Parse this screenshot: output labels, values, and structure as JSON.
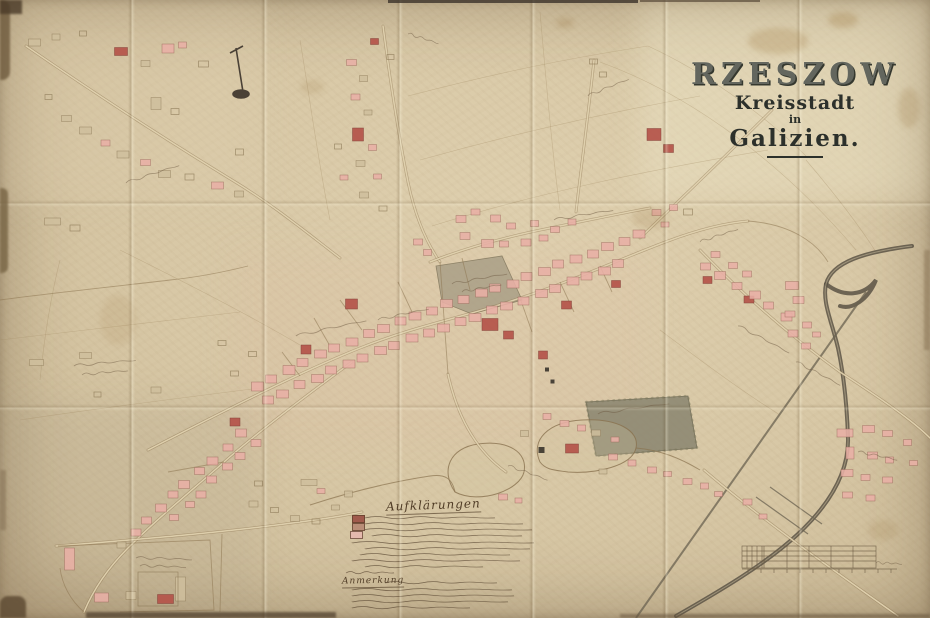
{
  "title": {
    "city": "RZESZOW",
    "subtitle": "Kreisstadt",
    "connector": "in",
    "region": "Galizien."
  },
  "legend": {
    "heading": "Aufklärungen",
    "note_heading": "Anmerkung",
    "swatches": [
      {
        "id": "swatch-1",
        "color": "#a05a4c"
      },
      {
        "id": "swatch-2",
        "color": "#b98d77"
      },
      {
        "id": "swatch-3",
        "color": "#e4b9ad"
      }
    ]
  },
  "colors": {
    "paper": "#d8c8a6",
    "building_pink": "#e9b0a6",
    "building_red": "#b5544a",
    "ink": "#6b573f",
    "water": "#5a5244",
    "title_ink": "#2c302b"
  }
}
